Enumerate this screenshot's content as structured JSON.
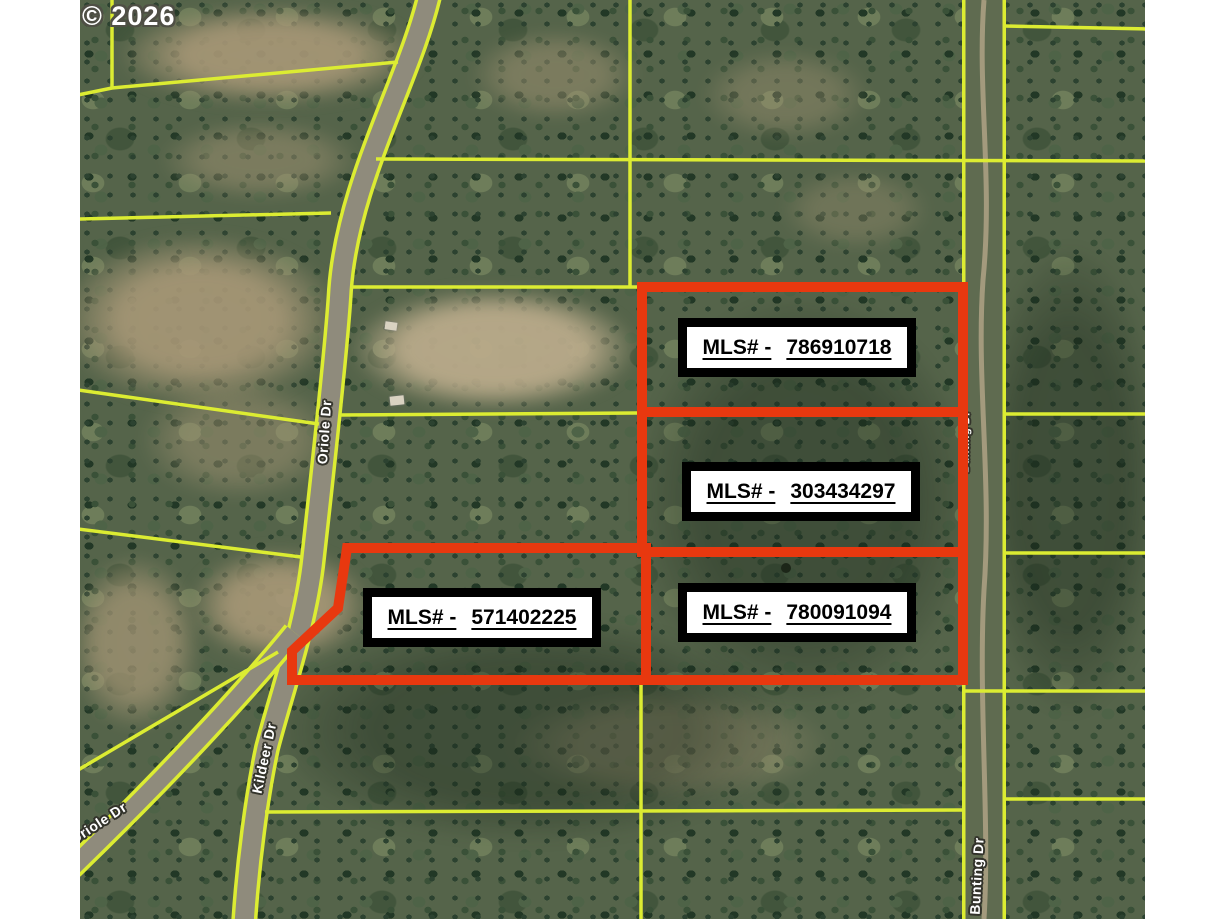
{
  "watermark": {
    "text": "© 2026"
  },
  "mls_labels": {
    "prefix": "MLS# -",
    "parcels": [
      {
        "number": "786910718"
      },
      {
        "number": "303434297"
      },
      {
        "number": "571402225"
      },
      {
        "number": "780091094"
      }
    ]
  },
  "streets": [
    {
      "name": "Oriole Dr"
    },
    {
      "name": "Kildeer Dr"
    },
    {
      "name": "Oriole Dr"
    },
    {
      "name": "Bunting Dr"
    },
    {
      "name": "Bunting Dr"
    }
  ],
  "colors": {
    "parcel_line": "#dcec32",
    "highlight_outline": "#e8380f",
    "label_background": "#ffffff",
    "label_frame": "#000000"
  }
}
